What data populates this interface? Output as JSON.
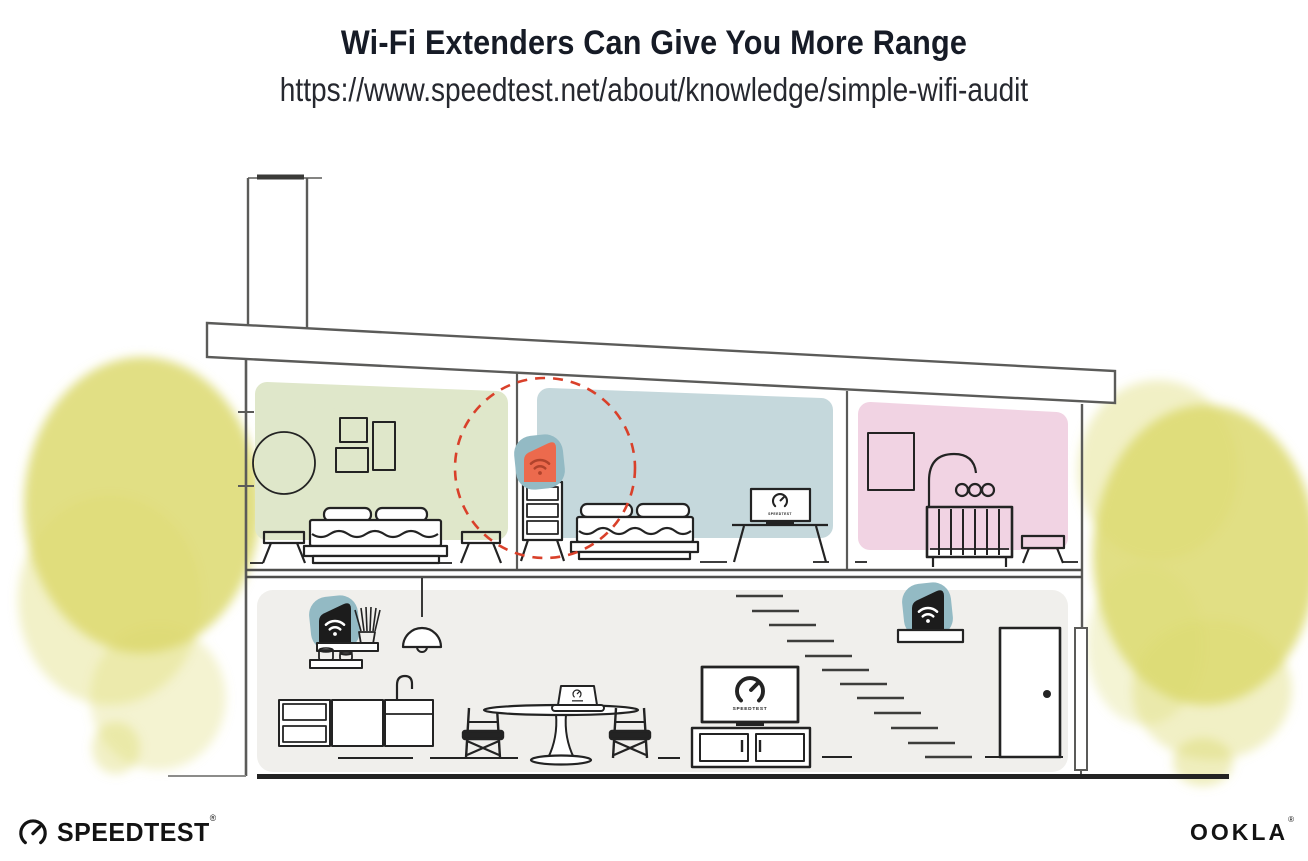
{
  "header": {
    "title": "Wi-Fi Extenders Can Give You More Range",
    "subtitle_url": "https://www.speedtest.net/about/knowledge/simple-wifi-audit"
  },
  "illustration": {
    "description": "Cutaway side view of a two-story house: Wi-Fi router on a kitchen shelf downstairs, one extender by the stairs shelf, and one orange extender on a dresser upstairs highlighted by a dashed range circle.",
    "rooms": [
      "green bedroom",
      "blue bedroom",
      "pink nursery",
      "open kitchen and living area"
    ],
    "devices": [
      "wifi-router-kitchen-shelf",
      "wifi-extender-upstairs-dresser",
      "wifi-extender-stairs-shelf"
    ],
    "tv_bedroom_label": "SPEEDTEST",
    "tv_living_label": "SPEEDTEST",
    "colors": {
      "room_green": "#dfe7ca",
      "room_blue": "#c5d8dc",
      "room_pink": "#f1d3e3",
      "device_teal": "#93bac4",
      "extender_orange": "#ec6a4d",
      "extender_wifi_dark": "#b0432c",
      "device_black": "#1c1c1c",
      "device_wifi_white": "#ffffff",
      "range_red": "#d9402a",
      "foliage_yellow": "#dcd96f",
      "lower_floor_gray": "#f0efec",
      "structure_gray": "#5b5b59",
      "ink": "#232323"
    }
  },
  "footer": {
    "speedtest_wordmark": "SPEEDTEST",
    "speedtest_reg_mark": "®",
    "ookla_wordmark": "OOKLA",
    "ookla_reg_mark": "®"
  }
}
